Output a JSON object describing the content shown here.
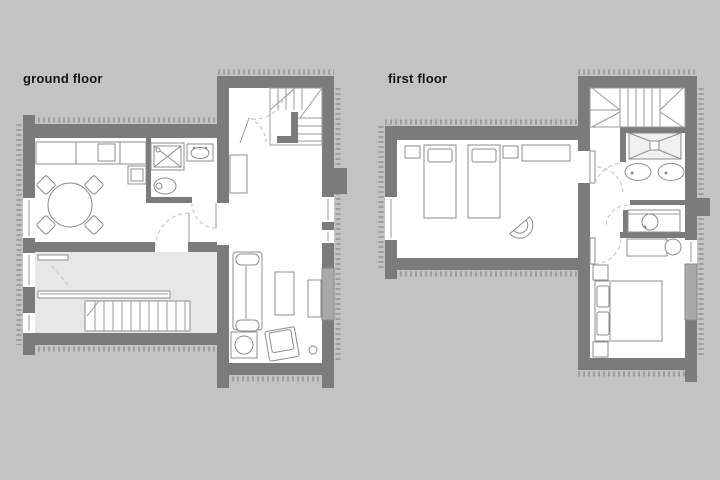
{
  "labels": {
    "ground": "ground floor",
    "first": "first floor"
  },
  "colors": {
    "background": "#c3c3c3",
    "wall": "#7b7b7b",
    "room_fill": "#ffffff",
    "stair_void_fill": "#e7e7e7",
    "furniture_line": "#8c8c8c",
    "door_swing_dash": "#c9c9c9",
    "window_panel": "#a9a9a9",
    "insulation_hatch": "#9e9e9e",
    "label_text": "#151515"
  },
  "plans": [
    {
      "label": "ground floor",
      "rooms": [
        "entry with winder staircase",
        "kitchen-dining room",
        "shower room",
        "double-height stair hall",
        "living room"
      ],
      "fixtures": [
        "kitchen counter",
        "cooktop",
        "under-counter appliance",
        "round dining table with four chairs",
        "shower",
        "washbasin",
        "toilet",
        "wardrobe",
        "handrail",
        "straight staircase down",
        "sofa",
        "coffee table",
        "tv sideboard",
        "stove table",
        "armchair"
      ]
    },
    {
      "label": "first floor",
      "rooms": [
        "winder staircase landing",
        "twin bedroom",
        "bathroom with shower and two washbasins",
        "wc",
        "hallway",
        "double bedroom"
      ],
      "fixtures": [
        "two single beds with pillows",
        "nightstands",
        "desk",
        "shell chair",
        "shower tray",
        "two washbasins",
        "washbasin cabinet",
        "dresser",
        "round stool",
        "double bed with pillows"
      ]
    }
  ]
}
